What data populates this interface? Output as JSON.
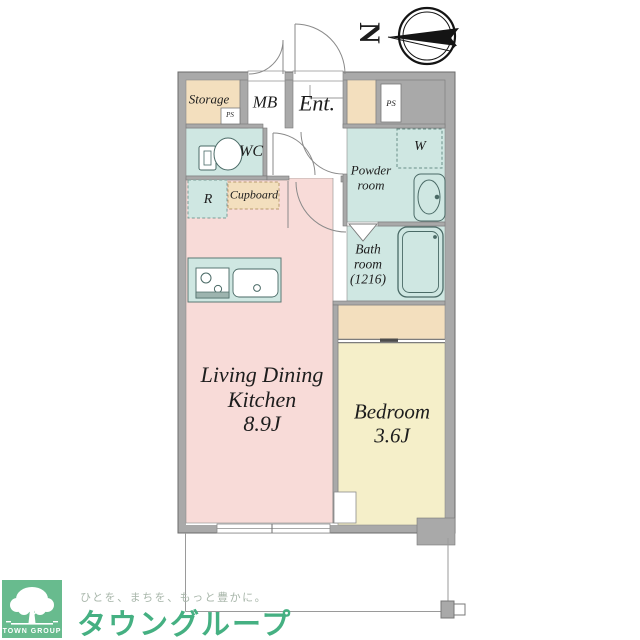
{
  "compass": {
    "north_label": "N"
  },
  "plan": {
    "rooms": {
      "storage": {
        "label": "Storage"
      },
      "storage_ps": {
        "label": "PS"
      },
      "meter_box": {
        "label": "MB"
      },
      "entrance": {
        "label": "Ent."
      },
      "pipe_space": {
        "label": "PS"
      },
      "wc": {
        "label": "WC"
      },
      "powder_room": {
        "lines": [
          "Powder",
          "room"
        ]
      },
      "washer": {
        "label": "W"
      },
      "refrigerator": {
        "label": "R"
      },
      "cupboard": {
        "label": "Cupboard"
      },
      "bathroom": {
        "lines": [
          "Bath",
          "room",
          "(1216)"
        ]
      },
      "ldk": {
        "lines": [
          "Living Dining",
          "Kitchen",
          "8.9J"
        ]
      },
      "bedroom": {
        "lines": [
          "Bedroom",
          "3.6J"
        ]
      }
    }
  },
  "branding": {
    "logo_square_text": "TOWN GROUP",
    "tagline": "ひとを、まちを、もっと豊かに。",
    "brand_name": "タウングループ"
  },
  "colors": {
    "wall_gray": "#a9a9a9",
    "room_pink": "#f8dbd8",
    "room_yellow": "#f5efc9",
    "room_teal": "#cfe7e2",
    "room_beige": "#f3dfbe",
    "logo_green": "#68bb8e",
    "brand_green": "#45b082",
    "tagline_gray": "#a8b6aa"
  }
}
